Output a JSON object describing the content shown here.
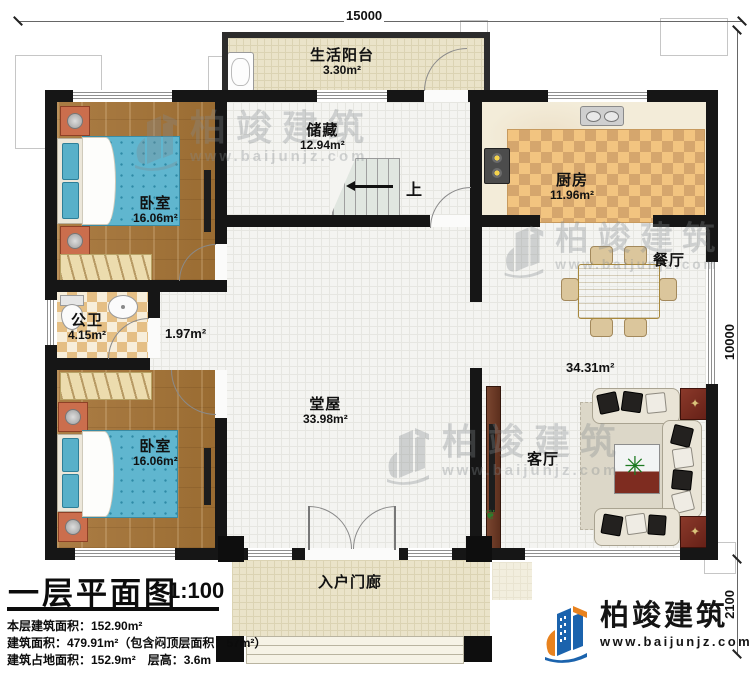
{
  "dimensions": {
    "top": "15000",
    "right_upper": "10000",
    "right_lower": "2100"
  },
  "rooms": {
    "balcony": {
      "name": "生活阳台",
      "area": "3.30m²"
    },
    "storage": {
      "name": "储藏",
      "area": "12.94m²"
    },
    "kitchen": {
      "name": "厨房",
      "area": "11.96m²"
    },
    "bedroom_top": {
      "name": "卧室",
      "area": "16.06m²"
    },
    "bedroom_bottom": {
      "name": "卧室",
      "area": "16.06m²"
    },
    "bathroom": {
      "name": "公卫",
      "area": "4.15m²"
    },
    "hallway": {
      "area": "1.97m²"
    },
    "hall": {
      "name": "堂屋",
      "area": "33.98m²"
    },
    "dining": {
      "name": "餐厅"
    },
    "living": {
      "name": "客厅"
    },
    "open_area": {
      "area": "34.31m²"
    },
    "porch": {
      "name": "入户门廊"
    },
    "stairs": {
      "up_label": "上"
    }
  },
  "title_block": {
    "title": "一层平面图",
    "scale": "1:100",
    "info_lines": [
      "本层建筑面积：152.90m²",
      "建筑面积：479.91m²（包含闷顶层面积：57m²）",
      "建筑占地面积：152.9m²　层高：3.6m"
    ]
  },
  "brand": {
    "company": "柏竣建筑",
    "website": "www.baijunjz.com"
  },
  "watermark": {
    "company": "柏竣建筑",
    "website": "www.baijunjz.com"
  },
  "colors": {
    "accent_blue": "#1b63ad",
    "accent_orange": "#e8821e",
    "wall": "#161616"
  }
}
